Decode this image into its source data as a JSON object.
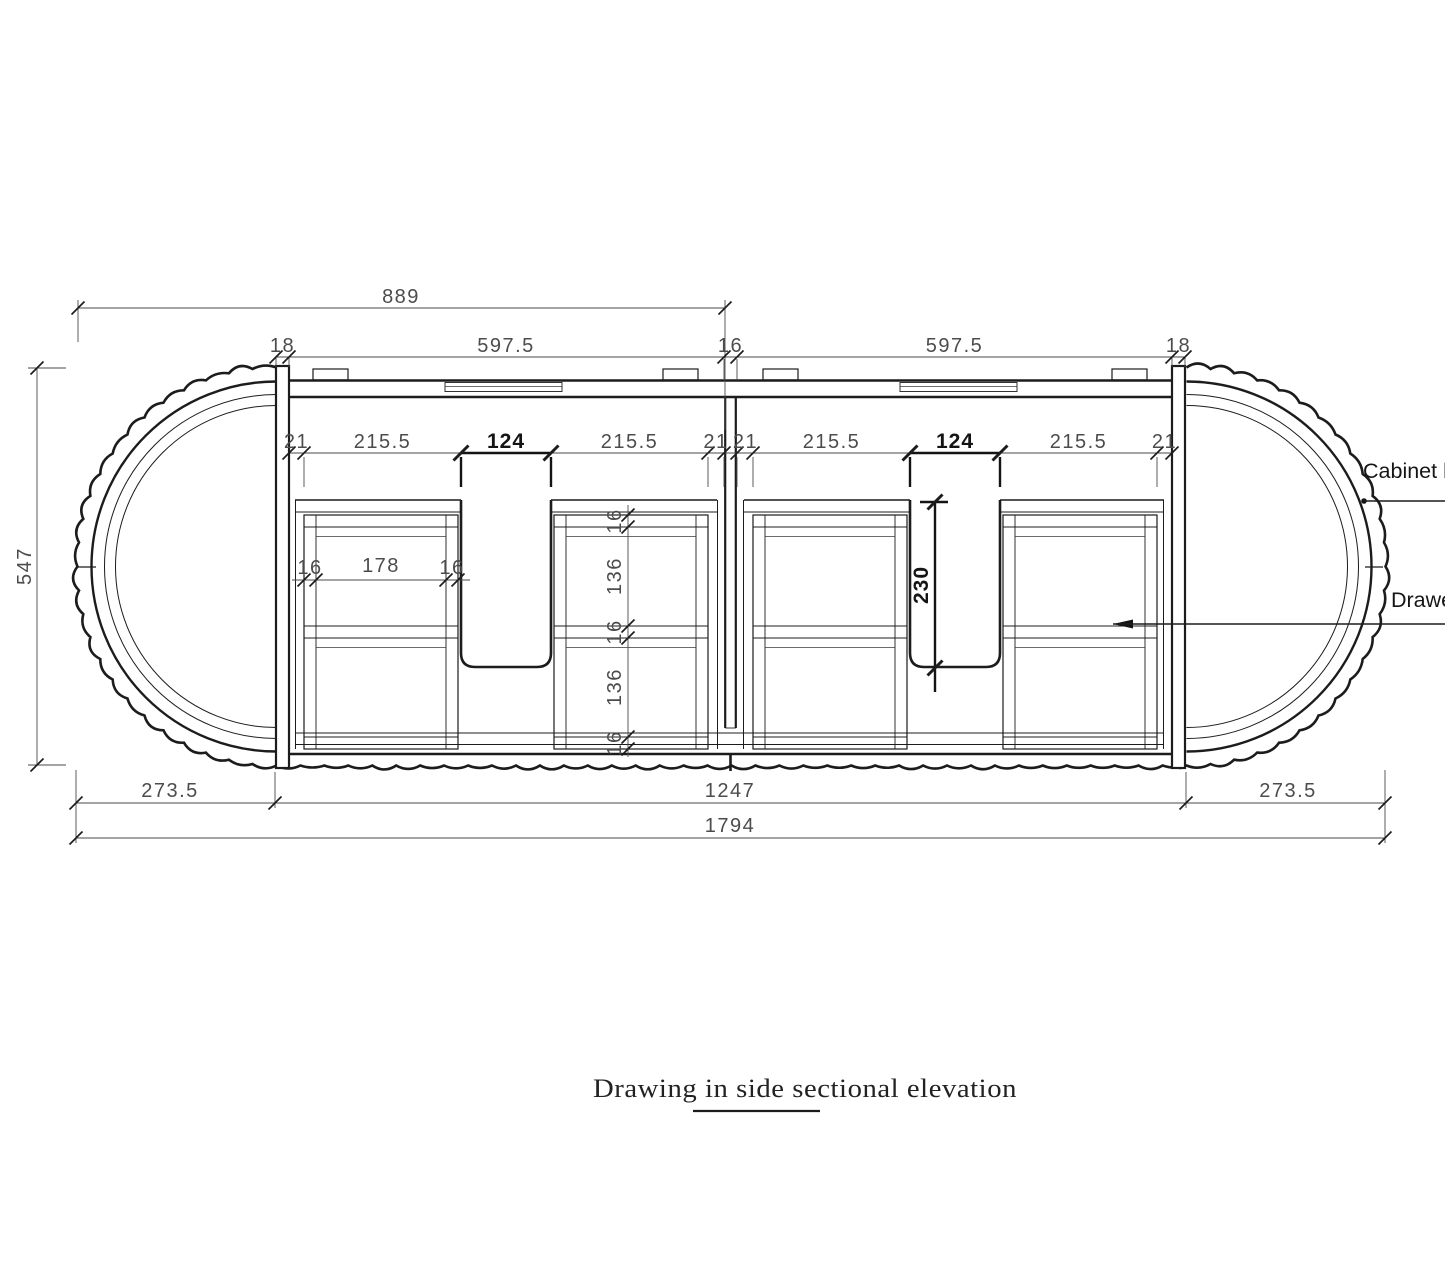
{
  "title": {
    "text": "Drawing in side sectional elevation"
  },
  "callouts": {
    "cabinet": "Cabinet body",
    "drawer": "Drawer"
  },
  "dims": {
    "overall_width_top": "889",
    "top": [
      "18",
      "597.5",
      "16",
      "597.5",
      "18"
    ],
    "upper": [
      "21",
      "215.5",
      "124",
      "215.5",
      "21",
      "21",
      "215.5",
      "124",
      "215.5",
      "21"
    ],
    "height": "547",
    "drawer_inner": [
      "16",
      "178",
      "16"
    ],
    "vertical_stack": [
      "16",
      "136",
      "16",
      "136",
      "16"
    ],
    "notch_depth": "230",
    "bottom_left": "273.5",
    "bottom_center": "1247",
    "bottom_right": "273.5",
    "overall_width": "1794"
  }
}
